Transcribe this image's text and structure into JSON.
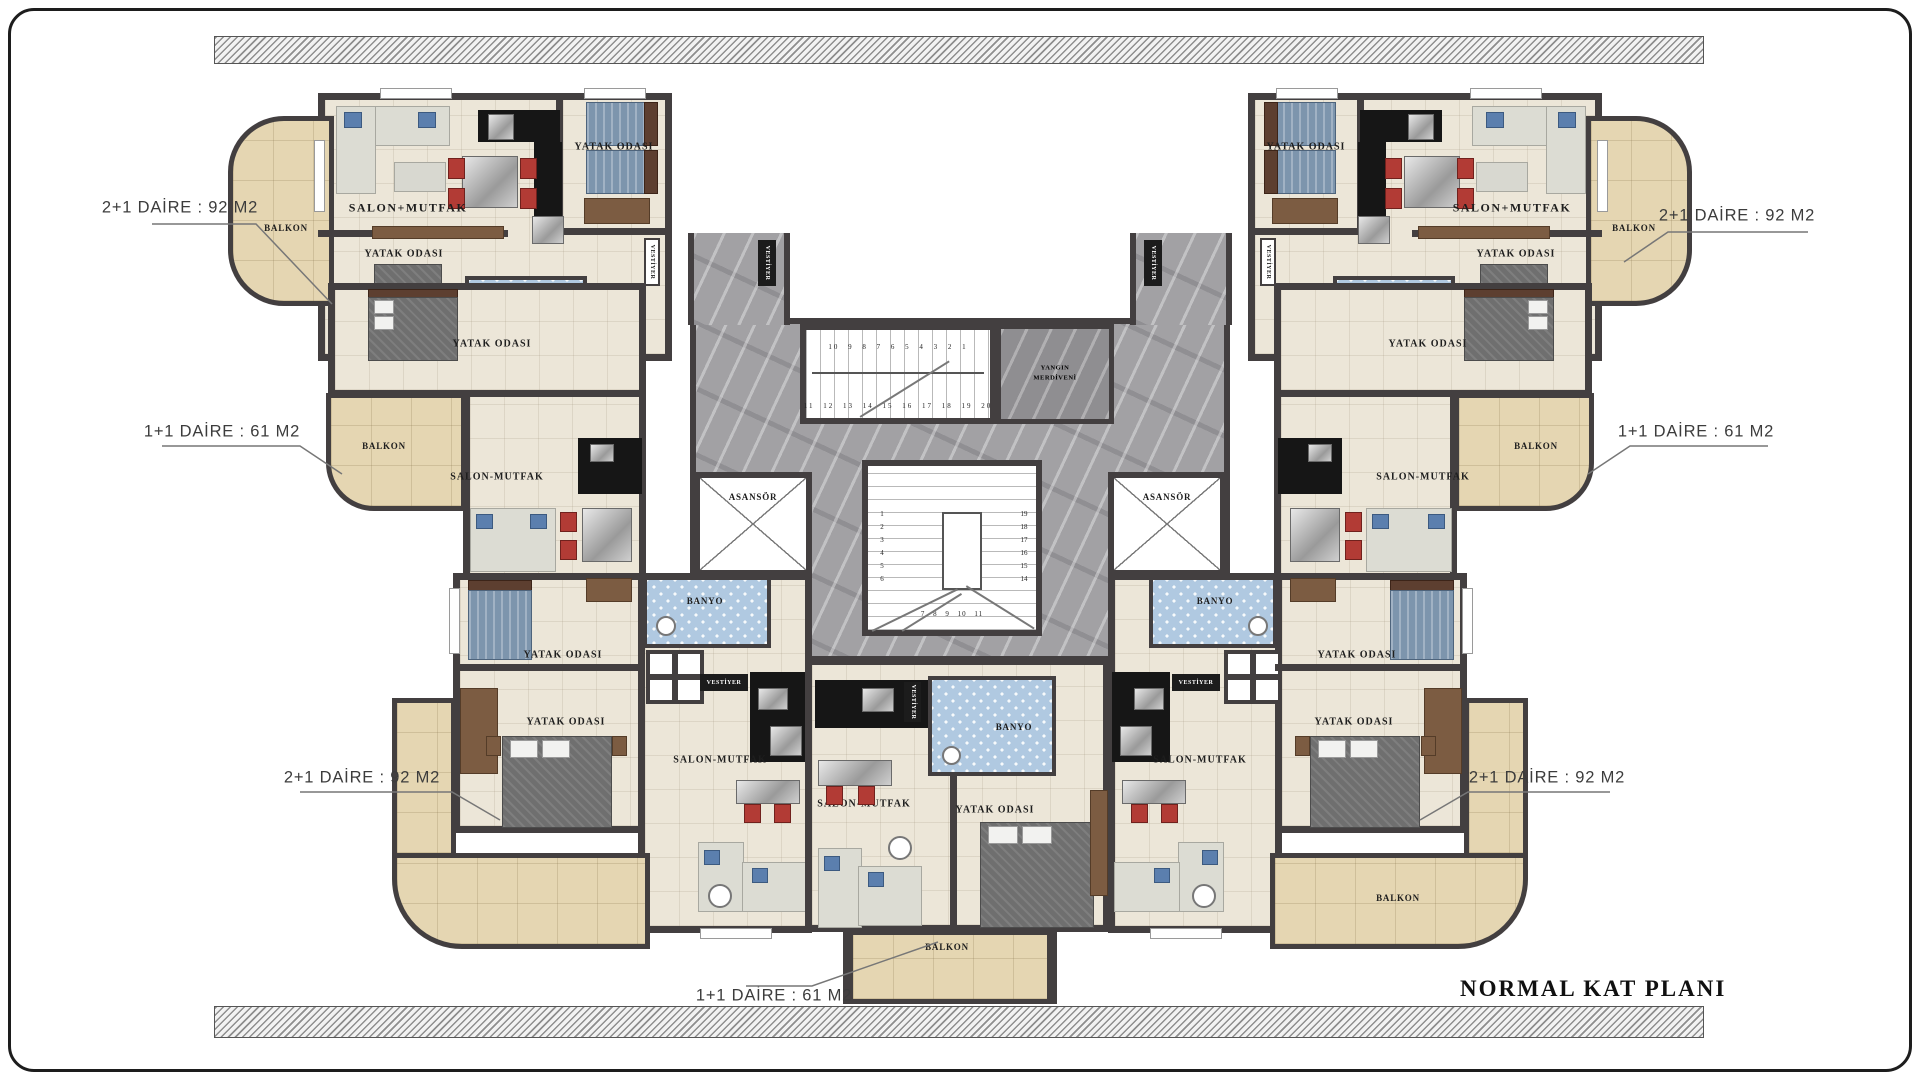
{
  "title": "NORMAL KAT PLANI",
  "apartments": {
    "top_left": {
      "type_label": "2+1 DAİRE : 92 M2"
    },
    "mid_left": {
      "type_label": "1+1 DAİRE : 61 M2"
    },
    "bottom_left": {
      "type_label": "2+1 DAİRE : 92 M2"
    },
    "top_right": {
      "type_label": "2+1 DAİRE : 92 M2"
    },
    "mid_right": {
      "type_label": "1+1 DAİRE : 61 M2"
    },
    "bottom_right": {
      "type_label": "2+1 DAİRE : 92 M2"
    },
    "bottom_center": {
      "type_label": "1+1 DAİRE : 61 M2"
    }
  },
  "rooms": {
    "living_kitchen_plus": "SALON+MUTFAK",
    "living_kitchen": "SALON-MUTFAK",
    "bedroom": "YATAK ODASI",
    "bathroom": "BANYO",
    "balcony": "BALKON",
    "wardrobe": "VESTİYER",
    "elevator": "ASANSÖR",
    "fire_escape": "YANGIN MERDİVENİ"
  },
  "stairs": {
    "top_row_numbers": "10 9 8 7 6 5 4 3 2 1",
    "bottom_row_numbers": "11 12 13 14 15 16 17 18 19 20",
    "main_left_column": "1\n2\n3\n4\n5\n6",
    "main_right_column": "19\n18\n17\n16\n15\n14",
    "main_bottom_row": "7   8   9   10   11"
  },
  "colors": {
    "wall": "#433f40",
    "floor_cream": "#ece6d8",
    "balcony_tan": "#e5d6b2",
    "corridor_marble": "#a2a1a4",
    "bathroom_blue": "#b0c9e1",
    "accent_red": "#b23b35",
    "bed_blue": "#7d95ad"
  }
}
